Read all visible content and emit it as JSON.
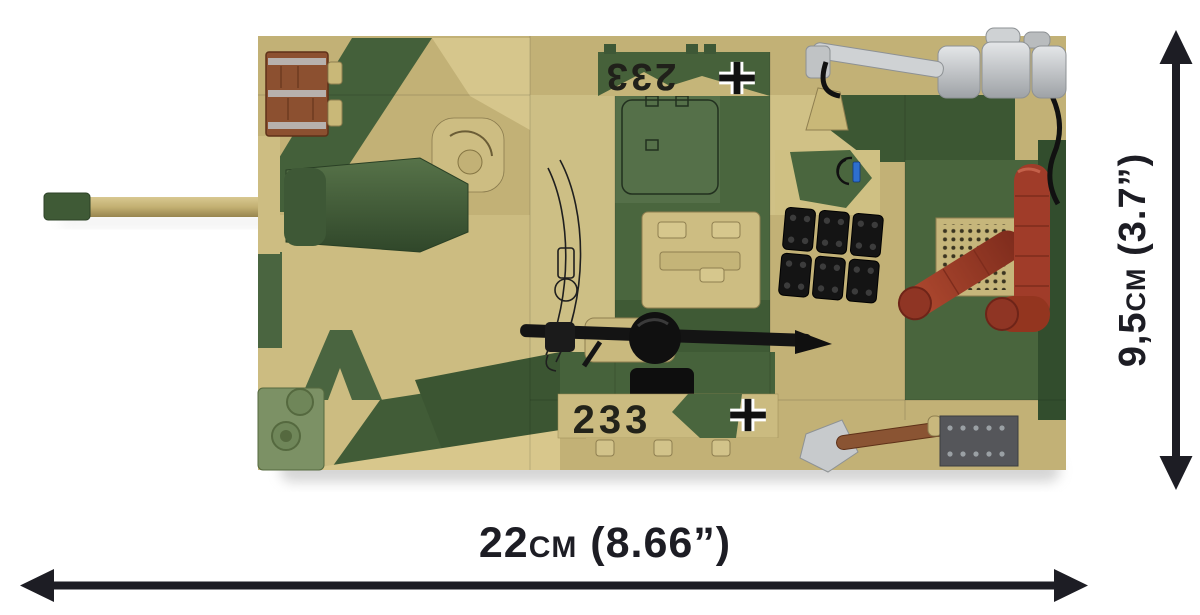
{
  "dimensions": {
    "width_label": "22cm (8.66”)",
    "height_label": "9,5cm (3.7”)"
  },
  "tank": {
    "marking_number": "233"
  },
  "colors": {
    "background": "#FFFFFF",
    "dimension_lines": "#1D1D24",
    "camo_tan": "#C2B176",
    "camo_tan_light": "#D8C88F",
    "camo_green": "#4A663E",
    "camo_green_dark": "#3C5733",
    "toolbox_brown": "#8C5030",
    "exhaust_red_brown": "#9E3D2B",
    "metal_silver": "#C7CACC",
    "tool_black": "#161616",
    "accent_sage_green": "#7C9165",
    "periscope_blue": "#2E6FCF"
  }
}
